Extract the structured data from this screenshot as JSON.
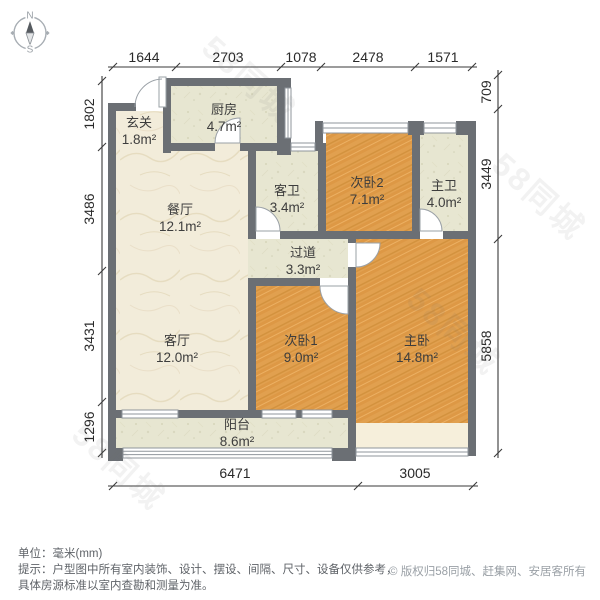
{
  "compass": {
    "north_label": "N",
    "south_label": "S"
  },
  "rooms": [
    {
      "name": "玄关",
      "area": "1.8m²"
    },
    {
      "name": "厨房",
      "area": "4.7m²"
    },
    {
      "name": "餐厅",
      "area": "12.1m²"
    },
    {
      "name": "客卫",
      "area": "3.4m²"
    },
    {
      "name": "次卧2",
      "area": "7.1m²"
    },
    {
      "name": "主卫",
      "area": "4.0m²"
    },
    {
      "name": "过道",
      "area": "3.3m²"
    },
    {
      "name": "客厅",
      "area": "12.0m²"
    },
    {
      "name": "次卧1",
      "area": "9.0m²"
    },
    {
      "name": "主卧",
      "area": "14.8m²"
    },
    {
      "name": "阳台",
      "area": "8.6m²"
    }
  ],
  "dims": {
    "top": [
      "1644",
      "2703",
      "1078",
      "2478",
      "1571"
    ],
    "left": [
      "1802",
      "3486",
      "3431",
      "1296"
    ],
    "right": [
      "709",
      "3449",
      "5858"
    ],
    "bottom": [
      "6471",
      "3005"
    ]
  },
  "footer": {
    "unit_note": "单位：毫米(mm)",
    "tip_line1": "提示：户型图中所有室内装饰、设计、摆设、间隔、尺寸、设备仅供参考，",
    "tip_line2": "具体房源标准以室内查勘和测量为准。",
    "copyright": "© 版权归58同城、赶集网、安居客所有"
  },
  "watermark": {
    "text": "58同城"
  },
  "colors": {
    "wall": "#6b6f74",
    "wood_floor": "#e1a04f",
    "marble_floor": "#f2ecda",
    "tile_floor": "#e7e6d1",
    "bay_window_floor": "#f6efdb",
    "dimension_text": "#2a2a2a",
    "legend_text": "#5f6368",
    "copyright_text": "#9aa0a6"
  }
}
